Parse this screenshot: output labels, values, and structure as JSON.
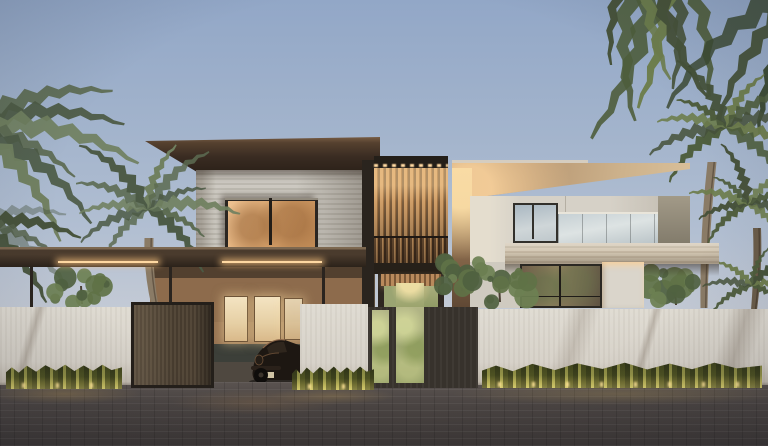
{
  "scene": {
    "kind": "architectural exterior render",
    "labels": {
      "sky": "dusk sky",
      "villa": "modern two-story villa",
      "left_wing": "travertine volume with dark cantilevered roof",
      "lit_window": "warm glowing upper window with palm reflections",
      "slat_screen": "backlit vertical wood slat screen with balcony",
      "right_wing": "white volume with tan roof, glass balustrade and balcony",
      "carport": "flat carport canopy with LED strip lighting",
      "car": "dark classic sports car in driveway",
      "entry_gate": "bronze entry gate",
      "entrance": "charcoal entrance wall with green moss-stone panels",
      "perimeter_wall": "white perimeter wall",
      "hedges": "uplit hedges along the wall",
      "driveway": "dark paved driveway",
      "palms": "palm trees and overhanging fronds",
      "trees": "green garden trees"
    }
  },
  "palette": {
    "sky_top": "#92a7c7",
    "sky_mid": "#b2bfd2",
    "sky_low": "#c8cdd6",
    "roof_dark": "#3a2c22",
    "travertine": "#c6c2b9",
    "window_glow": "#dca76f",
    "slat_wood": "#c79a66",
    "led_warm": "#ffd9a2",
    "roof_tan": "#cdb28c",
    "wall_white": "#d6d1c7",
    "balcony": "#c4b7a2",
    "canopy_dark": "#2b221a",
    "perimeter_wall": "#e0dcd3",
    "gate_bronze": "#544839",
    "entrance_dark": "#37322c",
    "moss_panel": "#9aa472",
    "hedge_dark": "#474d24",
    "hedge_glow": "#e3d678",
    "driveway": "#4a4442",
    "car_body": "#1d1712",
    "palm_green": "#4e5d3c",
    "palm_gray_green": "#5c6b52",
    "palm_dark": "#46523a",
    "trunk_brown": "#8a7b66",
    "tree_green": "#5f7247"
  }
}
